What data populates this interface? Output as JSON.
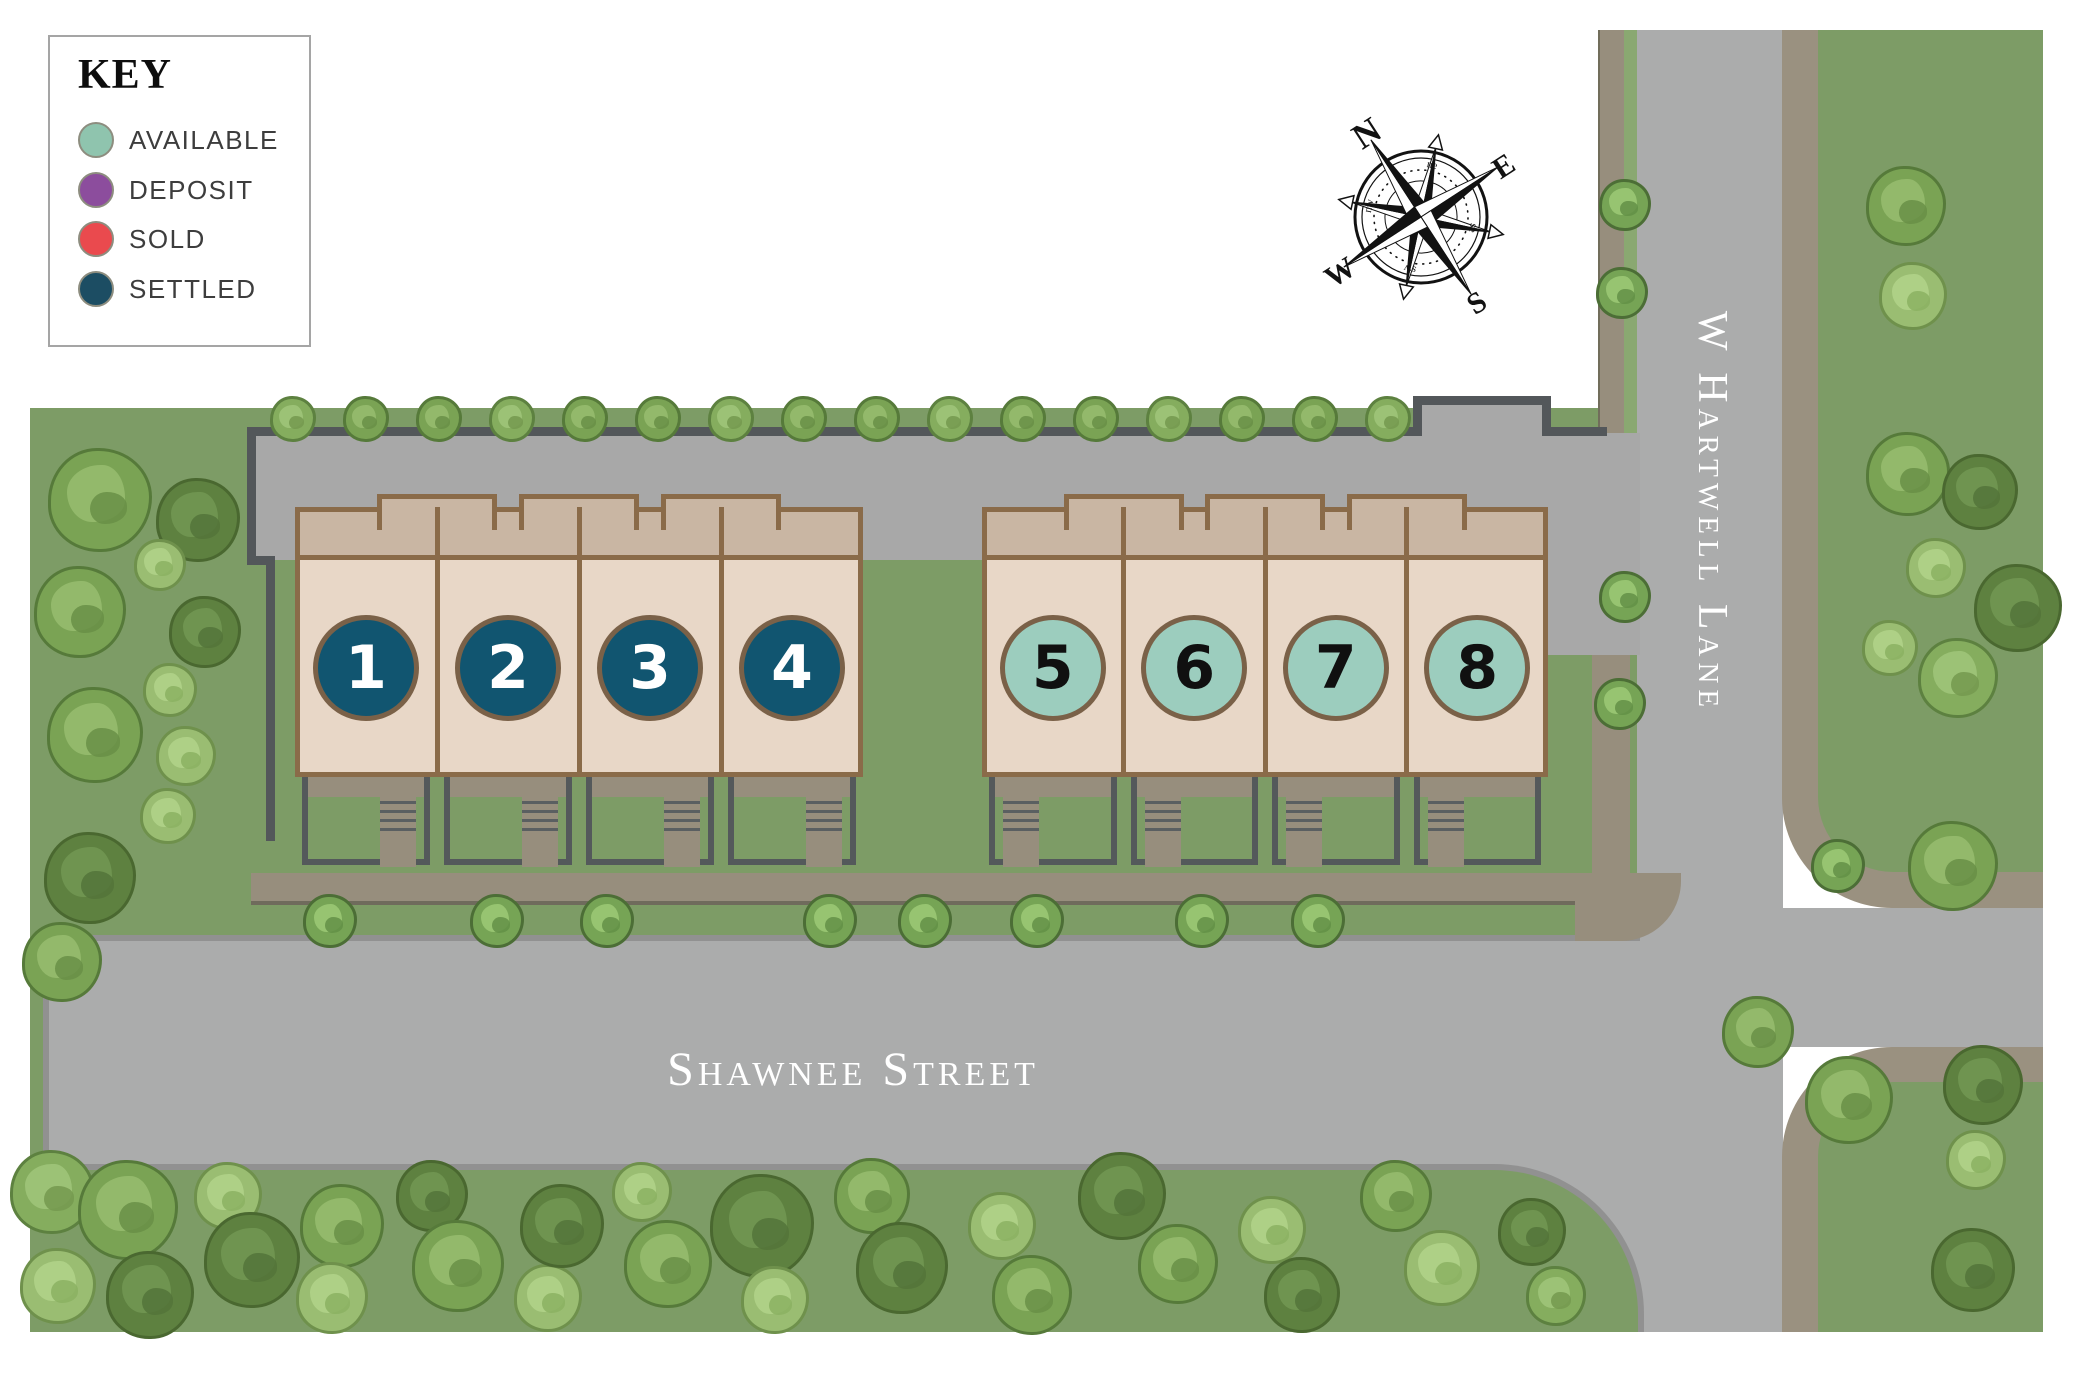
{
  "legend": {
    "title": "KEY",
    "items": [
      {
        "label": "AVAILABLE",
        "color": "#8fc4ae",
        "status": "available"
      },
      {
        "label": "DEPOSIT",
        "color": "#8c4d9d",
        "status": "deposit"
      },
      {
        "label": "SOLD",
        "color": "#ea4a4e",
        "status": "sold"
      },
      {
        "label": "SETTLED",
        "color": "#1c4d63",
        "status": "settled"
      }
    ]
  },
  "streets": {
    "horizontal": "Shawnee Street",
    "vertical": "W Hartwell Lane"
  },
  "compass": {
    "cardinals": [
      "N",
      "E",
      "S",
      "W"
    ],
    "intercardinals": [
      "ne",
      "se",
      "sw",
      "nw"
    ]
  },
  "units": [
    {
      "number": "1",
      "status": "settled"
    },
    {
      "number": "2",
      "status": "settled"
    },
    {
      "number": "3",
      "status": "settled"
    },
    {
      "number": "4",
      "status": "settled"
    },
    {
      "number": "5",
      "status": "available"
    },
    {
      "number": "6",
      "status": "available"
    },
    {
      "number": "7",
      "status": "available"
    },
    {
      "number": "8",
      "status": "available"
    }
  ],
  "status_colors": {
    "available": {
      "fill": "#9ccdbe",
      "text": "#101010"
    },
    "deposit": {
      "fill": "#8c4d9d",
      "text": "#ffffff"
    },
    "sold": {
      "fill": "#ea4a4e",
      "text": "#ffffff"
    },
    "settled": {
      "fill": "#115570",
      "text": "#ffffff"
    }
  }
}
